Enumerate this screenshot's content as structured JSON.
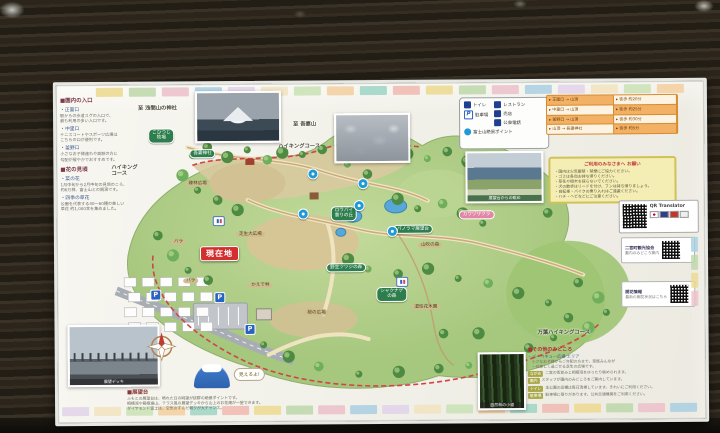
{
  "board": {
    "tiles": {
      "palette": [
        "#ecd98e",
        "#bcd7a9",
        "#ecc0ca",
        "#a9cfe2",
        "#e3d2ea",
        "#f1e3c0",
        "#c9e2b4",
        "#f3cf9f",
        "#9ed3c4",
        "#f0b9b0"
      ]
    },
    "left_column": {
      "sections": [
        {
          "header": "■園内の入口",
          "items": [
            {
              "title": "・正面口",
              "lines": [
                "駅からの歩道スグの入口で、",
                "最も利用の多い入口です。"
              ]
            },
            {
              "title": "・中里口",
              "lines": [
                "テニスコートやスポーツ広場は",
                "こちらの口が便利です。"
              ]
            },
            {
              "title": "・釜野口",
              "lines": [
                "小さなお子様連れや高齢の方に",
                "勾配が緩やかでおすすめです。"
              ]
            }
          ]
        },
        {
          "header": "■花の見頃",
          "items": [
            {
              "title": "・菜の花",
              "lines": [
                "1月中旬から2月中旬の見頃のころ、",
                "約6万株、富士山との競演です。"
              ]
            },
            {
              "title": "・四季の草花",
              "lines": [
                "公園を代表する40〜60種の美しい",
                "草花 約1,000本を集めました。"
              ]
            }
          ]
        }
      ]
    },
    "map": {
      "labels": [
        {
          "t": "至 浅間山の神社",
          "x": 82,
          "y": 21,
          "c": "plain"
        },
        {
          "t": "至 吾妻山",
          "x": 237,
          "y": 38,
          "c": "plain"
        },
        {
          "t": "ハイキング\nコース",
          "x": 55,
          "y": 80,
          "c": "plain"
        },
        {
          "t": "ハイキングコース",
          "x": 222,
          "y": 60,
          "c": "plain"
        },
        {
          "t": "こひつじ\n牧場",
          "x": 92,
          "y": 44,
          "c": "pill"
        },
        {
          "t": "吾妻神社",
          "x": 133,
          "y": 65,
          "c": "pill"
        },
        {
          "t": "疎林広場",
          "x": 129,
          "y": 97,
          "c": "tan"
        },
        {
          "t": "芝生大広場",
          "x": 179,
          "y": 148,
          "c": "tan"
        },
        {
          "t": "バラ",
          "x": 114,
          "y": 155,
          "c": "tan"
        },
        {
          "t": "バラ",
          "x": 126,
          "y": 194,
          "c": "tan"
        },
        {
          "t": "現在地",
          "x": 143,
          "y": 162,
          "c": "cur"
        },
        {
          "t": "ロウバイ\n香りの丘",
          "x": 274,
          "y": 123,
          "c": "pill"
        },
        {
          "t": "パノラマ展望台",
          "x": 336,
          "y": 142,
          "c": "pill"
        },
        {
          "t": "カワヅザクラ",
          "x": 402,
          "y": 128,
          "c": "pink"
        },
        {
          "t": "山吹の森",
          "x": 361,
          "y": 160,
          "c": "tan"
        },
        {
          "t": "野生ツツジの森",
          "x": 269,
          "y": 180,
          "c": "pill"
        },
        {
          "t": "シャクナゲ\nの森",
          "x": 319,
          "y": 204,
          "c": "pill"
        },
        {
          "t": "桜の広場",
          "x": 247,
          "y": 227,
          "c": "tan"
        },
        {
          "t": "湿性花木園",
          "x": 354,
          "y": 222,
          "c": "tan"
        },
        {
          "t": "かえで林",
          "x": 191,
          "y": 199,
          "c": "tan"
        },
        {
          "t": "万葉ハイキングコース",
          "x": 480,
          "y": 248,
          "c": "plain"
        }
      ],
      "parking_icons": [
        [
          93,
          205
        ],
        [
          157,
          208
        ],
        [
          187,
          240
        ]
      ],
      "toilet_icons": [
        [
          156,
          132
        ],
        [
          339,
          194
        ]
      ],
      "fuji_spots": [
        [
          251,
          85
        ],
        [
          301,
          95
        ],
        [
          297,
          117
        ],
        [
          330,
          143
        ],
        [
          241,
          125
        ]
      ]
    },
    "legend": {
      "col1": [
        {
          "icon": "toilet-icon",
          "label": "トイレ"
        },
        {
          "icon": "parking-icon",
          "label": "駐車場"
        }
      ],
      "col2": [
        {
          "icon": "restaurant-icon",
          "label": "レストラン"
        },
        {
          "icon": "shop-icon",
          "label": "売店"
        },
        {
          "icon": "phone-icon",
          "label": "公衆電話"
        }
      ],
      "bottom": {
        "icon": "fuji-spot-icon",
        "label": "富士山絶景ポイント"
      }
    },
    "times": {
      "rows": [
        [
          "正面口 → 山頂",
          "徒歩 約20分"
        ],
        [
          "中里口 → 山頂",
          "徒歩 約25分"
        ],
        [
          "釜野口 → 山頂",
          "徒歩 約30分"
        ],
        [
          "山頂 → 吾妻神社",
          "徒歩 約5分"
        ]
      ]
    },
    "notes": {
      "title": "ご利用のみなさまへ お願い",
      "bullets": [
        "・園内は火気厳禁・禁煙にご協力ください。",
        "・ゴミは各自お持ち帰りください。",
        "・草花や樹木を採らないでください。",
        "・犬の散歩はリードを付け、フンは持ち帰りましょう。",
        "・自転車・バイクの乗り入れはご遠慮ください。",
        "・ハチ・ヘビなどにご注意ください。"
      ]
    },
    "qr": {
      "translator_label": "QR Translator",
      "cards": [
        {
          "heading": "二宮町観光協会",
          "caption": "園内のみどころ案内"
        },
        {
          "heading": "開花情報",
          "caption": "最新の開花状況はこちら"
        }
      ],
      "tab_colors": [
        "#a9cfe2",
        "#bcd7a9",
        "#ecd98e",
        "#ecc0ca"
      ]
    },
    "photos": {
      "valley_caption": "展望台からの眺め",
      "deck_caption": "展望デッキ",
      "trees_caption": "自然林の小道"
    },
    "viewpoint": {
      "header": "■展望台",
      "lines": [
        "ふもとの展望台は、晴れた日の眺望が抜群の絶景ポイントです。",
        "相模湾や箱根連山、テラス風の展望デッキから山上のお花畑が一望できます。",
        "ダイヤモンド富士は、空気のすんだ朝夕が大チャンス。"
      ],
      "bubble": "見えるよ!"
    },
    "others": {
      "header": "■その他のみどころ",
      "intro": "・バーベキュー広場 エリア",
      "intro_lines": [
        "小さなお子様からご年配の方まで、家族みんなが",
        "一日楽しく過ごせる芝生の広場です。"
      ],
      "rows": [
        {
          "tag": "ながめ",
          "text": "二宮の街並みと相模湾をゆったり眺められます。"
        },
        {
          "tag": "園内",
          "text": "スタッフが園内のみどころをご案内しています。"
        },
        {
          "tag": "トイレ",
          "text": "本公園の設備は毎日清掃しています。きれいにご利用ください。"
        },
        {
          "tag": "駐車場",
          "text": "駐車場に限りがあります。公共交通機関をご利用ください。"
        }
      ]
    }
  }
}
